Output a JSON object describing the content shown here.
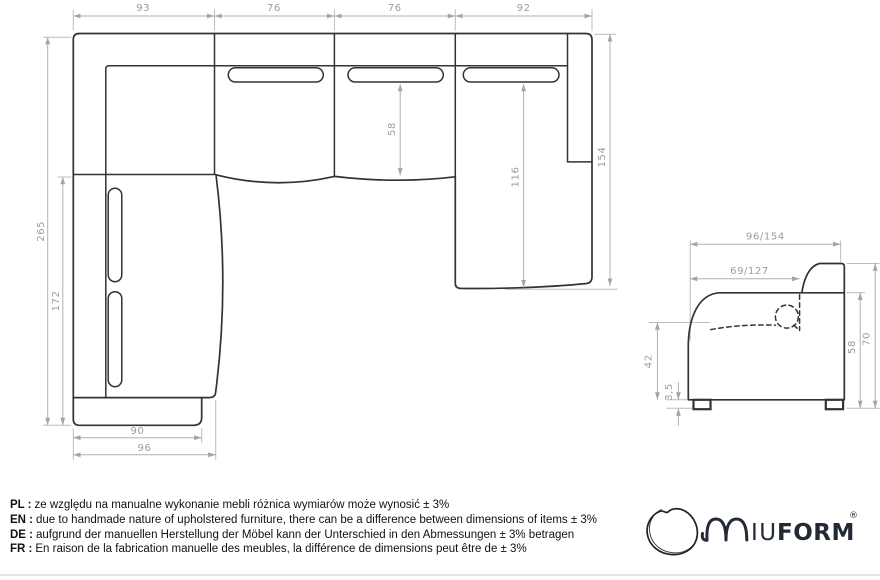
{
  "top_view": {
    "top_widths": [
      "93",
      "76",
      "76",
      "92"
    ],
    "left_outer": "265",
    "left_inner": "172",
    "seat_depth": "58",
    "chaise_length": "116",
    "right_depth": "154",
    "plinth_width": "90",
    "chaise_width": "96"
  },
  "side_view": {
    "overall_depth": "96/154",
    "seat_depth": "69/127",
    "seat_height": "42",
    "leg_height": "3,5",
    "arm_height": "58",
    "back_height": "70"
  },
  "notes": {
    "lines": [
      {
        "label": "PL :",
        "text": "ze względu na manualne wykonanie mebli różnica wymiarów może wynosić ± 3%"
      },
      {
        "label": "EN :",
        "text": "due to handmade nature of upholstered furniture, there can be a difference between dimensions of items ± 3%"
      },
      {
        "label": "DE :",
        "text": "aufgrund der manuellen Herstellung der Möbel kann der Unterschied in den Abmessungen ± 3% betragen"
      },
      {
        "label": "FR :",
        "text": "En raison de la fabrication manuelle des meubles, la différence de dimensions peut être de ± 3%"
      }
    ]
  },
  "logo": {
    "brand": "MIUFORM",
    "iu": "IU",
    "form": "FORM",
    "registered": "®"
  },
  "colors": {
    "drawing_line": "#333333",
    "dimension_line": "#b0b0b0",
    "dimension_text": "#9c9c9c",
    "note_text": "#111111",
    "logo": "#222a35",
    "background": "#ffffff"
  }
}
